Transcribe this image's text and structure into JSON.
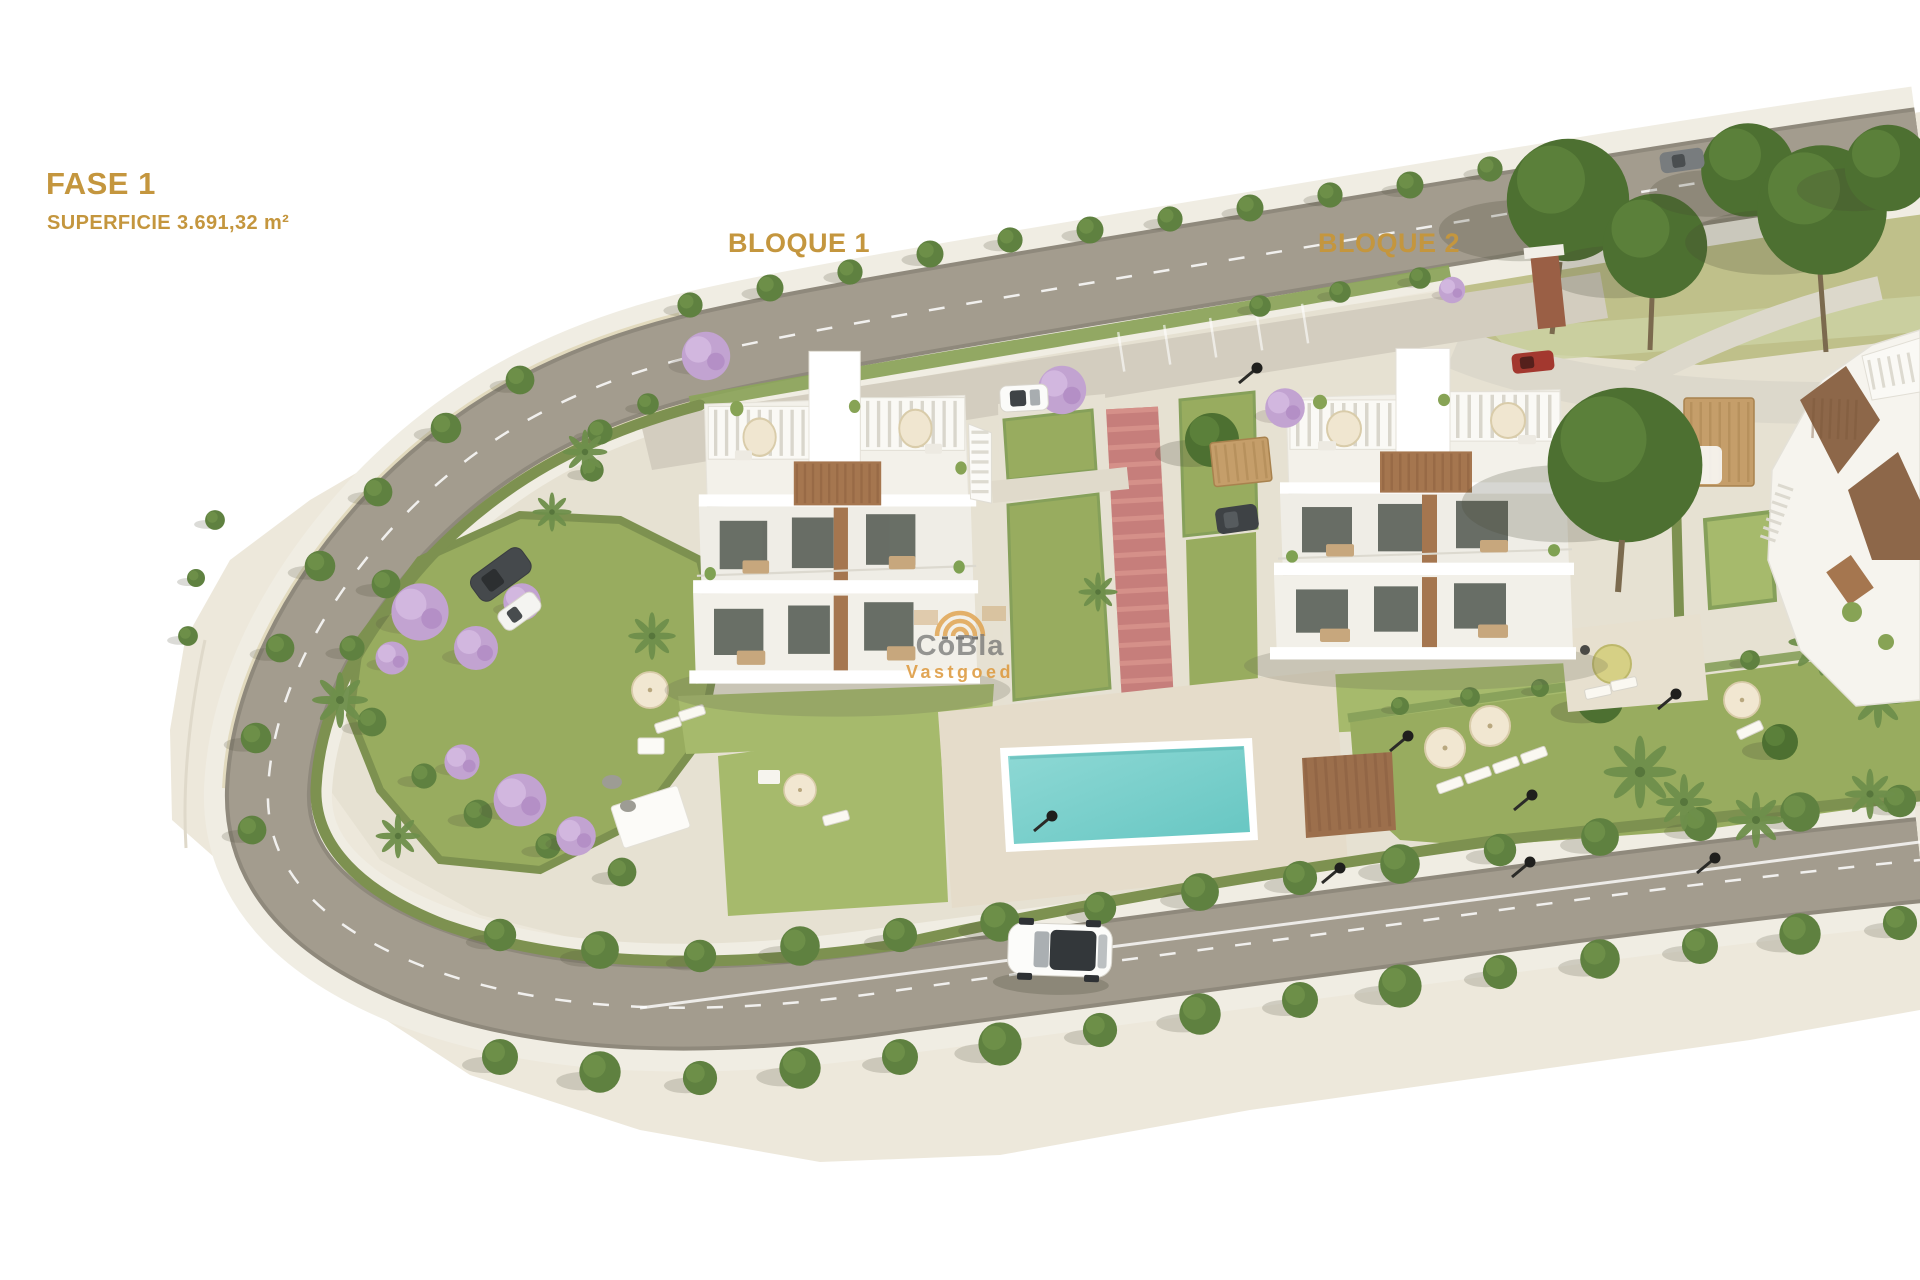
{
  "header": {
    "phase_label": "FASE 1",
    "area_label": "SUPERFICIE 3.691,32 m²"
  },
  "blocks": {
    "block1_label": "BLOQUE 1",
    "block2_label": "BLOQUE 2"
  },
  "watermark": {
    "brand": "CoBla",
    "subtitle": "Vastgoed",
    "icon": "concentric-arcs-logo-icon"
  },
  "palette": {
    "gold": "#C4963E",
    "terrain": "#EDE8DB",
    "inner": "#E6E1D2",
    "sidewalk": "#F0EDE3",
    "road": "#A39C8E",
    "road-edge": "#8F897C",
    "lawn": "#98AC5F",
    "lawn-light": "#A6BA6C",
    "hedge": "#7D9150",
    "tree": "#5F8140",
    "tree-dark": "#4D7031",
    "dry-grass": "#BDBE86",
    "jacaranda": "#C2A3D1",
    "jacaranda-light": "#D2B7DF",
    "pool": "#7BCFCB",
    "pool-deep": "#64C2BE",
    "pool-deck": "#E5DCCA",
    "wood": "#A5764F",
    "wood-deck": "#9C6F4C",
    "carport-wood": "#C59E6A",
    "window": "#5A6058",
    "facade": "#F1EFE8",
    "car-dark": "#45494C",
    "brick": "#9A5F45",
    "watermark-gray": "#6E6E6E",
    "watermark-orange": "#DE9A3F",
    "red-path": "#C67E7B",
    "red-path-stripe": "#D59089"
  }
}
